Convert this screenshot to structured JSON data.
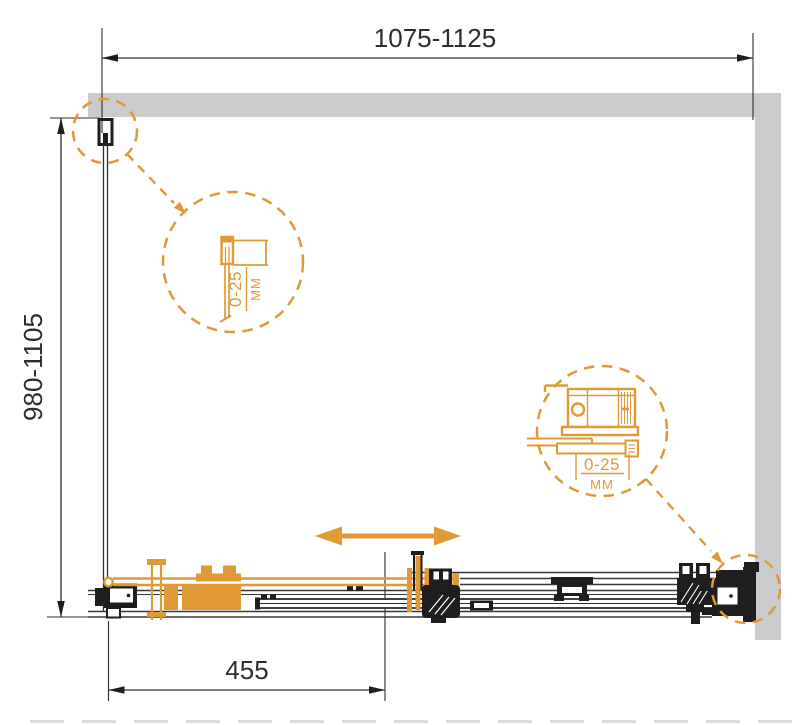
{
  "drawing": {
    "dimensions": {
      "top_width": "1075-1125",
      "left_height": "980-1105",
      "bottom_door": "455"
    },
    "callouts": {
      "wall_profile": {
        "range": "0-25",
        "unit": "MM"
      },
      "rail_bracket": {
        "range": "0-25",
        "unit": "MM"
      }
    },
    "colors": {
      "accent_orange": "#E19936",
      "wall_gray": "#CACBCC",
      "line_dark": "#2D2D2D"
    }
  }
}
